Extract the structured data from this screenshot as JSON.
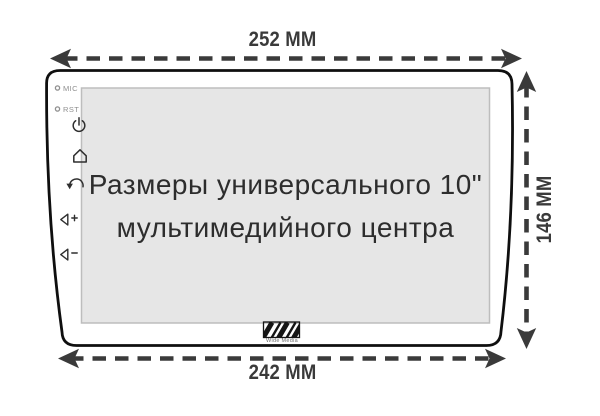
{
  "device": {
    "screen_title_line1": "Размеры универсального 10\"",
    "screen_title_line2": "мультимедийного центра",
    "side_controls": {
      "mic_label": "MIC",
      "rst_label": "RST"
    },
    "icons": {
      "power": "power-icon",
      "home": "home-icon",
      "back": "back-icon",
      "volume_up": "volume-up-icon",
      "volume_down": "volume-down-icon",
      "logo": "wide-media-logo"
    },
    "brand_label": "Wide Media"
  },
  "dimension_labels": {
    "top": "252 MM",
    "bottom": "242 MM",
    "right": "146 MM"
  },
  "colors": {
    "outline": "#0f0f0f",
    "screen_fill": "#e6e6e6",
    "screen_border": "#bdbdbd",
    "dimension": "#3a3a3a",
    "screen_text": "#2d2d2d",
    "muted_label": "#8f8f8f"
  }
}
